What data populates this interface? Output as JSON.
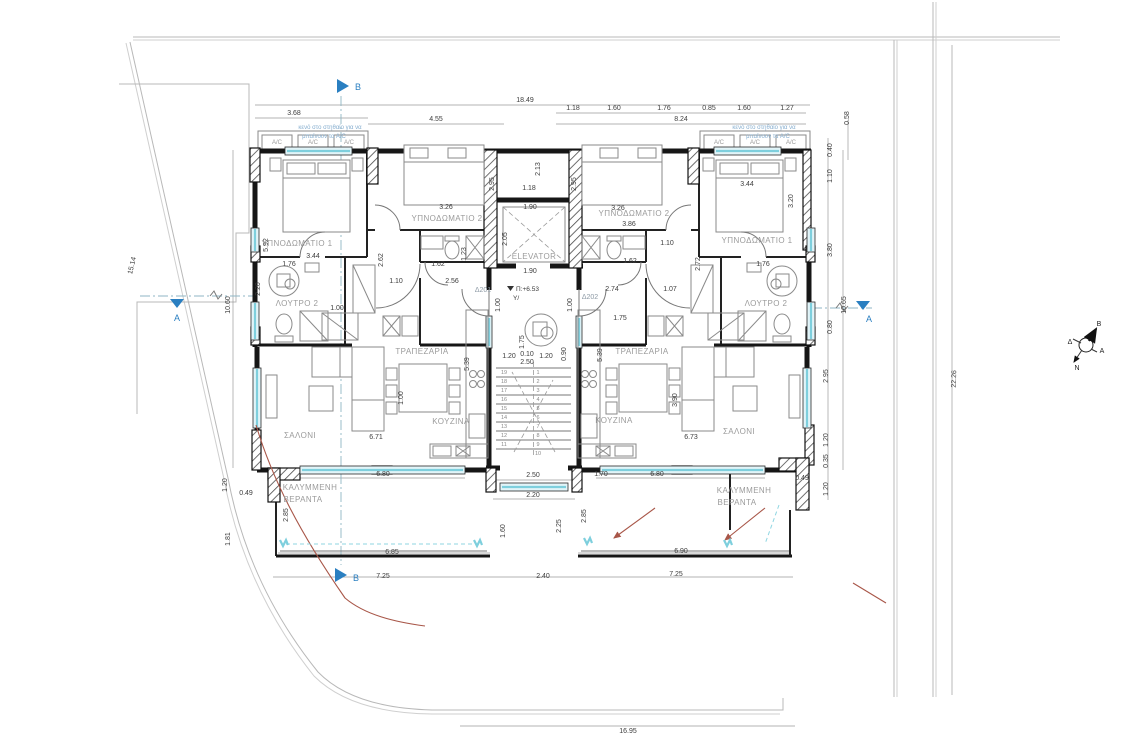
{
  "rooms": {
    "bedroom1": "ΥΠΝΟΔΩΜΑΤΙΟ 1",
    "bedroom2": "ΥΠΝΟΔΩΜΑΤΙΟ 2",
    "bath2": "ΛΟΥΤΡΟ 2",
    "salon": "ΣΑΛΟΝΙ",
    "dining": "ΤΡΑΠΕΖΑΡΙΑ",
    "kitchen": "ΚΟΥΖΙΝΑ",
    "veranda_1": "ΚΑΛΥΜΜΕΝΗ",
    "veranda_2": "ΒΕΡΑΝΤΑ"
  },
  "core": {
    "elevator": "ELEVATOR",
    "apt_left": "Δ201",
    "apt_right": "Δ202",
    "level": "Π:+6.53",
    "level_sub": "Υ/"
  },
  "notes": {
    "ac": "A/C",
    "ac_note_1": "κενό στο στηθαίο για να",
    "ac_note_2": "μπαίνουν τα Α/C"
  },
  "sections": {
    "a": "A",
    "b": "B"
  },
  "compass": {
    "north": "Β",
    "south": "Ν",
    "east": "Α",
    "west": "Δ"
  },
  "stairs": {
    "left": [
      "19",
      "18",
      "17",
      "16",
      "15",
      "14",
      "13",
      "12",
      "11"
    ],
    "right": [
      "1",
      "2",
      "3",
      "4",
      "5",
      "6",
      "7",
      "8",
      "9",
      "10"
    ]
  },
  "dims": {
    "d18_49": "18.49",
    "d8_24": "8.24",
    "d4_55": "4.55",
    "d3_68": "3.68",
    "d3_86": "3.86",
    "d3_80": "3.80",
    "d3_44": "3.44",
    "d3_26": "3.26",
    "d3_20": "3.20",
    "d3_90": "3.90",
    "d2_95": "2.95",
    "d2_85": "2.85",
    "d2_74": "2.74",
    "d2_72": "2.72",
    "d2_62": "2.62",
    "d2_56": "2.56",
    "d2_50": "2.50",
    "d2_40": "2.40",
    "d2_25": "2.25",
    "d2_20": "2.20",
    "d2_13": "2.13",
    "d2_05": "2.05",
    "d1_90": "1.90",
    "d1_81": "1.81",
    "d1_76": "1.76",
    "d1_75": "1.75",
    "d1_70": "1.70",
    "d1_62": "1.62",
    "d1_60": "1.60",
    "d1_27": "1.27",
    "d1_23": "1.23",
    "d1_20": "1.20",
    "d1_18": "1.18",
    "d1_10": "1.10",
    "d1_07": "1.07",
    "d1_00": "1.00",
    "d0_90": "0.90",
    "d0_85": "0.85",
    "d0_80": "0.80",
    "d0_58": "0.58",
    "d0_49": "0.49",
    "d0_40": "0.40",
    "d0_35": "0.35",
    "d0_10": "0.10",
    "d5_92": "5.92",
    "d5_39": "5.39",
    "d6_71": "6.71",
    "d6_73": "6.73",
    "d6_80": "6.80",
    "d6_85": "6.85",
    "d6_90": "6.90",
    "d7_25": "7.25",
    "d10_60": "10.60",
    "d10_65": "10.65",
    "d15_14": "15.14",
    "d16_95": "16.95",
    "d22_26": "22.26"
  },
  "colors": {
    "glass": "#7ecfdd",
    "section_blue": "#2a7fc1",
    "accent_red": "#a85648",
    "wall": "#161616"
  }
}
